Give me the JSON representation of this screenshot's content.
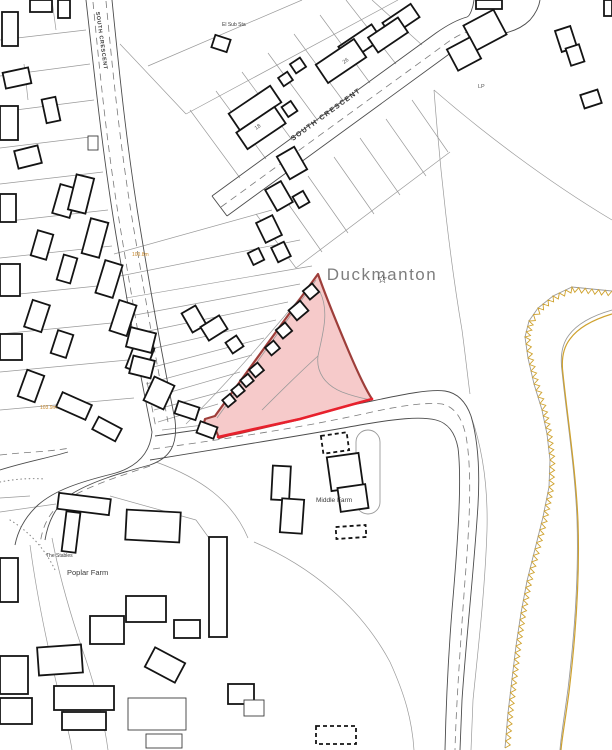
{
  "place": {
    "name": "Duckmanton"
  },
  "streets": {
    "diagonal": "SOUTH CRESCENT",
    "left": "SOUTH CRESCENT"
  },
  "features": {
    "el_sub_sta": "El Sub Sta",
    "middle_farm": "Middle Farm",
    "poplar_farm": "Poplar Farm",
    "the_stables": "The Stables"
  },
  "elevations": {
    "north": "100.8m",
    "south": "103.9m"
  },
  "house_numbers": {
    "n18": "18",
    "n26": "26",
    "lp": "LP"
  },
  "symbols": {
    "star": "☆"
  },
  "colors": {
    "site_fill": "#f6caca",
    "site_border": "#9e3e3a",
    "site_edge_red": "#e8212d",
    "boundary_gold": "#cfa22e",
    "label_gray": "#7e7e7e",
    "elevation_orange": "#c8882a"
  }
}
